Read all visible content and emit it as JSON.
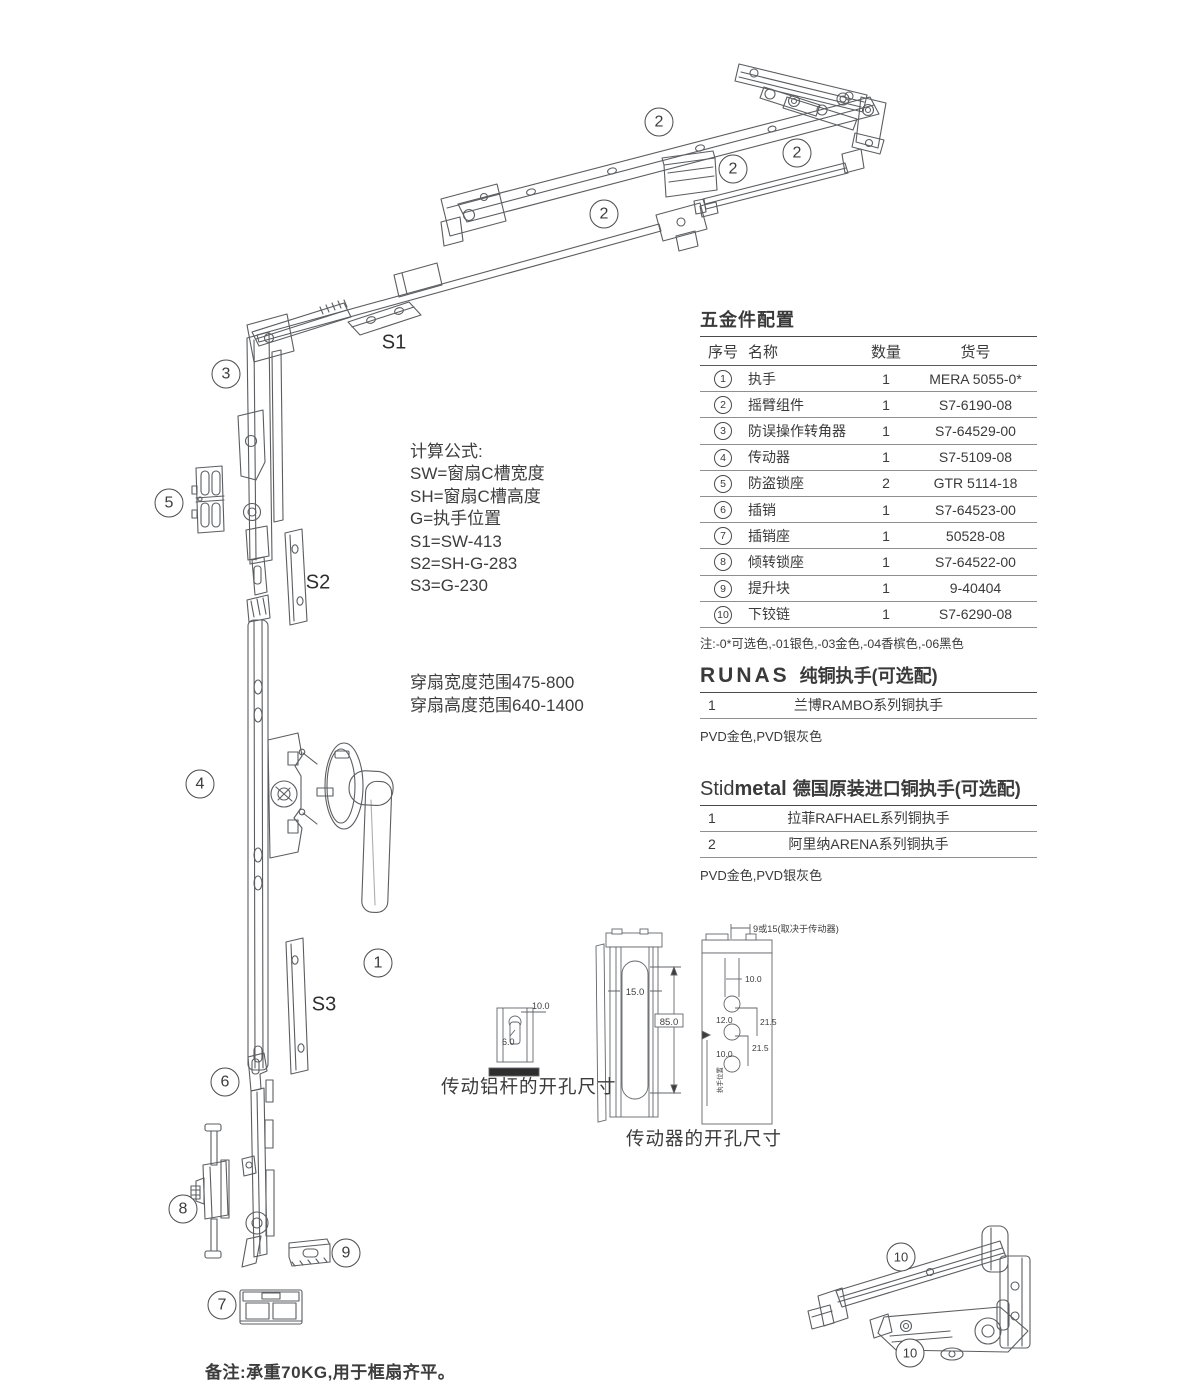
{
  "colors": {
    "ink": "#3a3a3a",
    "line_art": "#5b5d60",
    "table_line": "#8f8f8f"
  },
  "diagram": {
    "callouts": [
      {
        "label": "2",
        "x": 659,
        "y": 122
      },
      {
        "label": "2",
        "x": 733,
        "y": 169
      },
      {
        "label": "2",
        "x": 797,
        "y": 153
      },
      {
        "label": "2",
        "x": 604,
        "y": 214
      },
      {
        "label": "3",
        "x": 226,
        "y": 374
      },
      {
        "label": "5",
        "x": 169,
        "y": 503
      },
      {
        "label": "4",
        "x": 200,
        "y": 784
      },
      {
        "label": "1",
        "x": 378,
        "y": 963
      },
      {
        "label": "6",
        "x": 225,
        "y": 1082
      },
      {
        "label": "8",
        "x": 183,
        "y": 1209
      },
      {
        "label": "9",
        "x": 346,
        "y": 1253
      },
      {
        "label": "7",
        "x": 222,
        "y": 1305
      },
      {
        "label": "10",
        "x": 901,
        "y": 1257
      },
      {
        "label": "10",
        "x": 910,
        "y": 1353
      }
    ],
    "size_labels": [
      {
        "text": "S1",
        "x": 394,
        "y": 343
      },
      {
        "text": "S2",
        "x": 318,
        "y": 583
      },
      {
        "text": "S3",
        "x": 324,
        "y": 1005
      }
    ]
  },
  "formula_block": {
    "title": "计算公式:",
    "lines": [
      "SW=窗扇C槽宽度",
      "SH=窗扇C槽高度",
      "G=执手位置",
      "S1=SW-413",
      "S2=SH-G-283",
      "S3=G-230"
    ]
  },
  "range_block": {
    "lines": [
      "穿扇宽度范围475-800",
      "穿扇高度范围640-1400"
    ]
  },
  "hardware_table": {
    "title": "五金件配置",
    "columns": [
      "序号",
      "名称",
      "数量",
      "货号"
    ],
    "rows": [
      {
        "no": "1",
        "name": "执手",
        "qty": "1",
        "code": "MERA 5055-0*"
      },
      {
        "no": "2",
        "name": "摇臂组件",
        "qty": "1",
        "code": "S7-6190-08"
      },
      {
        "no": "3",
        "name": "防误操作转角器",
        "qty": "1",
        "code": "S7-64529-00"
      },
      {
        "no": "4",
        "name": "传动器",
        "qty": "1",
        "code": "S7-5109-08"
      },
      {
        "no": "5",
        "name": "防盗锁座",
        "qty": "2",
        "code": "GTR 5114-18"
      },
      {
        "no": "6",
        "name": "插销",
        "qty": "1",
        "code": "S7-64523-00"
      },
      {
        "no": "7",
        "name": "插销座",
        "qty": "1",
        "code": "50528-08"
      },
      {
        "no": "8",
        "name": "倾转锁座",
        "qty": "1",
        "code": "S7-64522-00"
      },
      {
        "no": "9",
        "name": "提升块",
        "qty": "1",
        "code": "9-40404"
      },
      {
        "no": "10",
        "name": "下铰链",
        "qty": "1",
        "code": "S7-6290-08"
      }
    ],
    "note": "注:-0*可选色,-01银色,-03金色,-04香槟色,-06黑色"
  },
  "runas_section": {
    "brand": "RUNAS",
    "title": "纯铜执手(可选配)",
    "rows": [
      {
        "no": "1",
        "name": "兰博RAMBO系列铜执手"
      }
    ],
    "note": "PVD金色,PVD银灰色"
  },
  "stidmetal_section": {
    "brand_light": "Stid",
    "brand_bold": "metal",
    "title": "德国原装进口铜执手(可选配)",
    "rows": [
      {
        "no": "1",
        "name": "拉菲RAFHAEL系列铜执手"
      },
      {
        "no": "2",
        "name": "阿里纳ARENA系列铜执手"
      }
    ],
    "note": "PVD金色,PVD银灰色"
  },
  "rod_drawing": {
    "caption": "传动铝杆的开孔尺寸",
    "dim_width": "10.0",
    "dim_slot": "6.0"
  },
  "driver_drawing": {
    "caption": "传动器的开孔尺寸",
    "slot_width": "15.0",
    "slot_height": "85.0",
    "top_dim": "9或15(取决于传动器)",
    "hole_dims": {
      "d1": "10.0",
      "d2": "12.0",
      "d3": "21.5",
      "d4": "10.0",
      "d5": "21.5"
    },
    "side_note": "执手位置"
  },
  "footer_note": "备注:承重70KG,用于框扇齐平。"
}
